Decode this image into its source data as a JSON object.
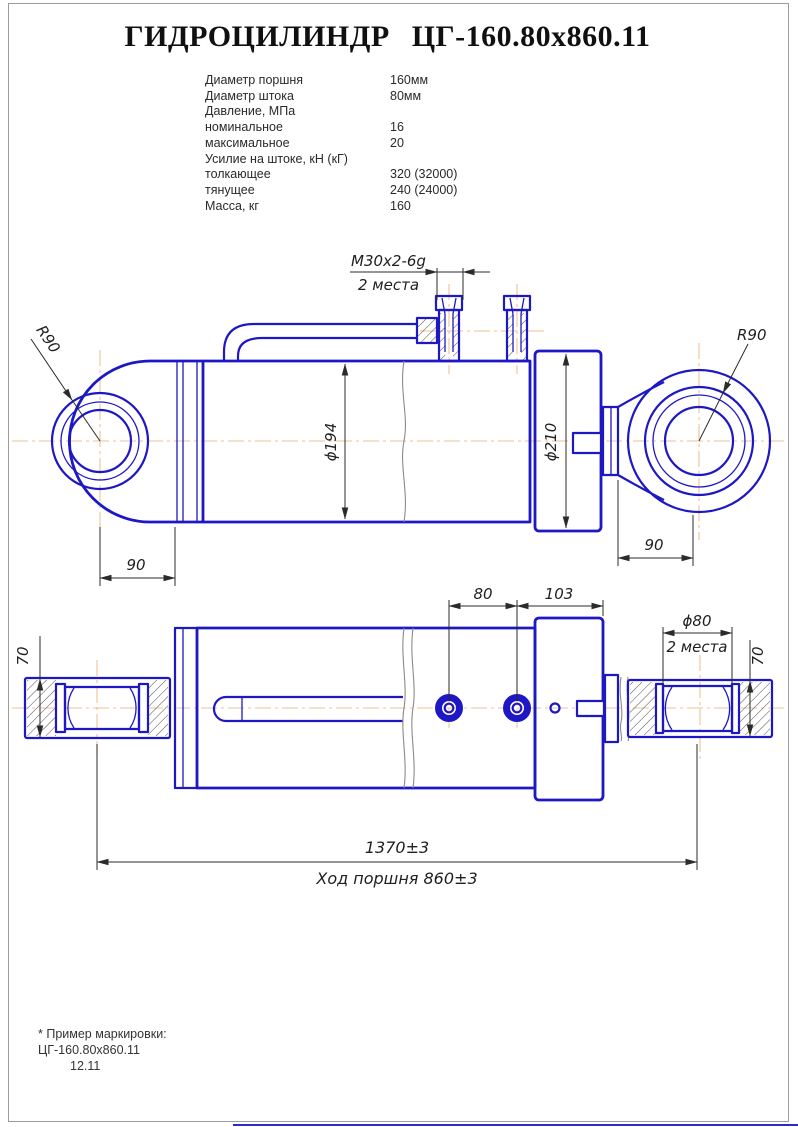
{
  "title": "ГИДРОЦИЛИНДР ЦГ-160.80х860.11",
  "specs": {
    "rows": [
      {
        "label": "Диаметр поршня",
        "value": "160мм"
      },
      {
        "label": "Диаметр штока",
        "value": "80мм"
      },
      {
        "label": "Давление, МПа",
        "value": ""
      },
      {
        "label": "номинальное",
        "value": "16"
      },
      {
        "label": "максимальное",
        "value": "20"
      },
      {
        "label": "Усилие на штоке, кН (кГ)",
        "value": ""
      },
      {
        "label": "толкающее",
        "value": "320 (32000)"
      },
      {
        "label": "тянущее",
        "value": "240 (24000)"
      },
      {
        "label": "Масса, кг",
        "value": "160"
      }
    ]
  },
  "drawing": {
    "colors": {
      "outline_blue": "#1d18c4",
      "centerline_tan": "#eec295",
      "dimension_dark": "#2b2b2b"
    },
    "labels": {
      "thread_callout": "М30х2-6g",
      "thread_places": "2 места",
      "radius_left": "R90",
      "radius_right": "R90",
      "bore_diameter": "ϕ194",
      "head_diameter": "ϕ210",
      "pin_width_left": "90",
      "pin_width_right": "90",
      "port_spacing": "80",
      "head_length": "103",
      "pin_bore_diameter": "ϕ80",
      "pin_bore_places": "2 места",
      "eye_width_left": "70",
      "eye_width_right": "70",
      "closed_length": "1370±3",
      "piston_stroke": "Ход поршня 860±3"
    }
  },
  "footnote": {
    "line1": "* Пример маркировки:",
    "line2": "ЦГ-160.80х860.11",
    "line3": "12.11"
  }
}
